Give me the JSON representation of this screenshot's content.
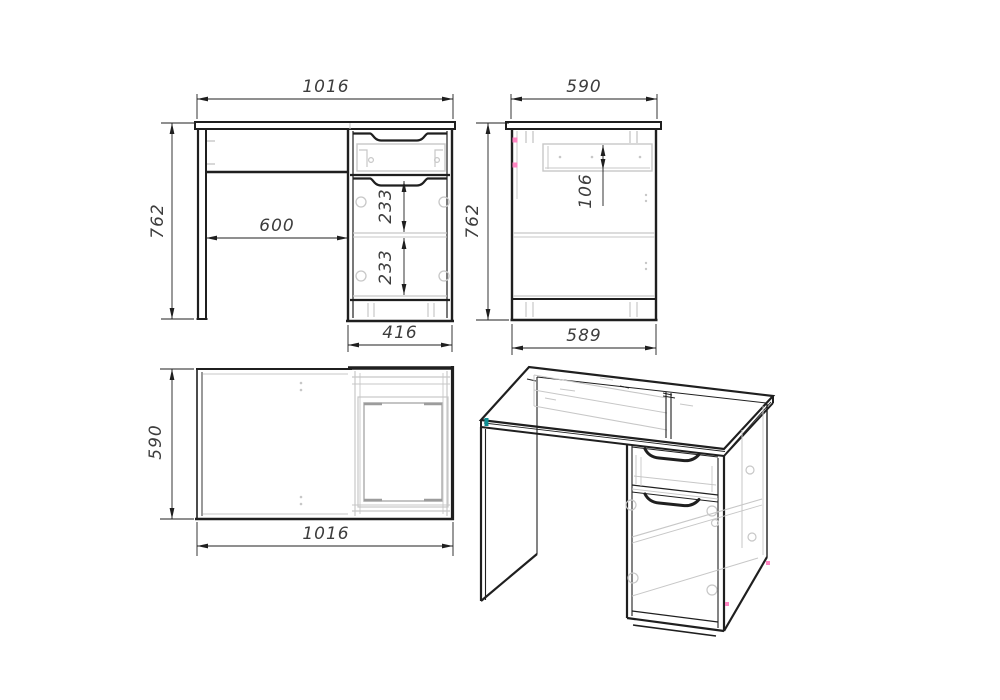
{
  "drawing_title": "desk-technical-drawing",
  "views": {
    "front": {
      "title": "front view",
      "dims": {
        "overall_width": "1016",
        "overall_height": "762",
        "knee_space_width": "600",
        "drawer_gap_upper": "233",
        "drawer_gap_lower": "233",
        "pedestal_width": "416"
      }
    },
    "side": {
      "title": "side view",
      "dims": {
        "top_depth": "590",
        "overall_height": "762",
        "drawer_side_height": "106",
        "carcass_depth": "589"
      }
    },
    "top": {
      "title": "top view",
      "dims": {
        "depth": "590",
        "overall_width": "1016"
      }
    },
    "iso": {
      "title": "perspective view"
    }
  },
  "colors": {
    "line": "#1f1f1f",
    "hidden": "#c7c7c7",
    "dimtext": "#3d3d3d",
    "pink": "#ff85c2",
    "teal": "#0d8e93",
    "bg": "#ffffff"
  }
}
